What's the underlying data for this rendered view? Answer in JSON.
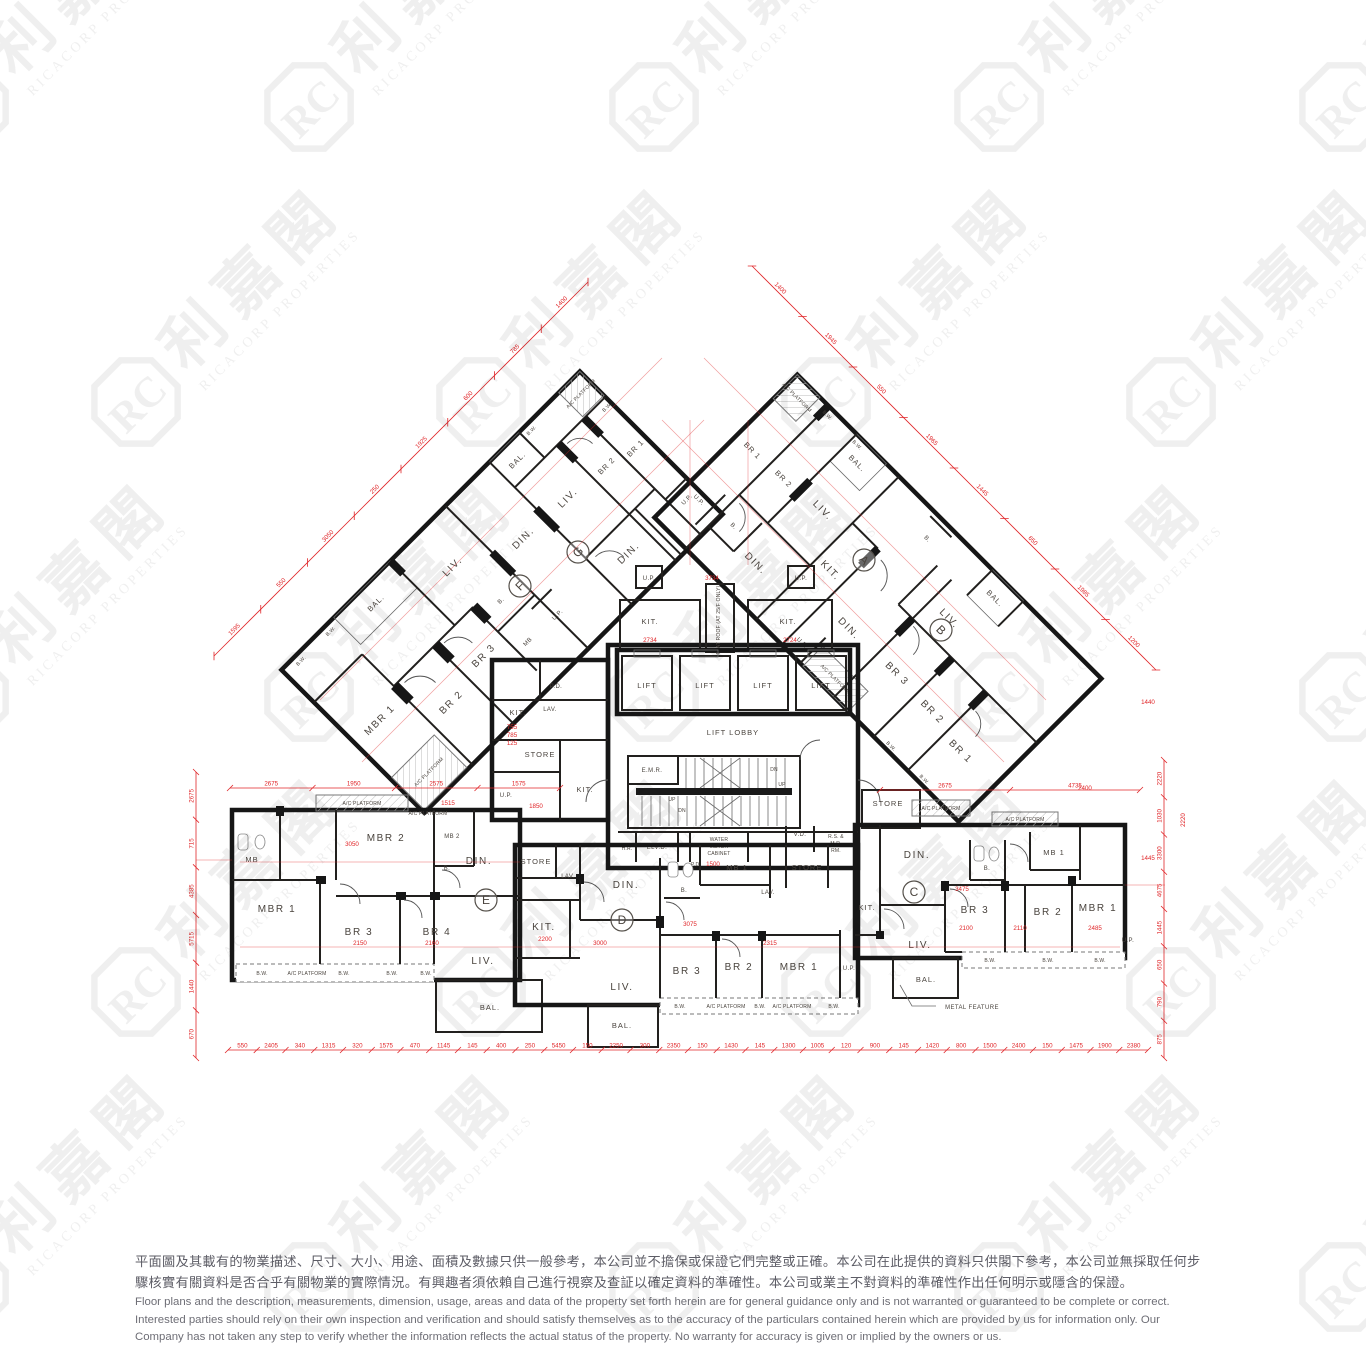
{
  "watermark": {
    "monogram": "RC",
    "cjk": "利嘉閣",
    "latin": "RICACORP PROPERTIES"
  },
  "units": {
    "a": "A",
    "b": "B",
    "c": "C",
    "d": "D",
    "e": "E",
    "f": "F",
    "g": "G"
  },
  "labels": {
    "lift": "LIFT",
    "lift_lobby": "LIFT LOBBY",
    "emr": "E.M.R.",
    "elvd": "ELV.D.",
    "hr": "H.R.",
    "pd": "P.D.",
    "vd": "V.D.",
    "water_meter": [
      "WATER",
      "METER",
      "CABINET"
    ],
    "rs_mr": [
      "R.S. &",
      "M.R.",
      "RM."
    ],
    "up": "UP",
    "dn": "DN",
    "flat_roof": "FLAT ROOF (AT 25/F ONLY)",
    "mbr1": "MBR 1",
    "mbr2": "MBR 2",
    "mb": "MB",
    "mb1": "MB 1",
    "mb2": "MB 2",
    "br1": "BR 1",
    "br2": "BR 2",
    "br3": "BR 3",
    "br4": "BR 4",
    "bath": "B.",
    "liv": "LIV.",
    "din": "DIN.",
    "kit": "KIT.",
    "bal": "BAL.",
    "bw": "B.W.",
    "up_platform": "U.P.",
    "ac_platform": "A/C PLATFORM",
    "store": "STORE",
    "lav": "LAV.",
    "metal_feature": "METAL FEATURE"
  },
  "dims": {
    "bottom": [
      "550",
      "2405",
      "340",
      "1315",
      "320",
      "1575",
      "470",
      "1145",
      "145",
      "400",
      "250",
      "5450",
      "150",
      "2250",
      "300",
      "2350",
      "150",
      "1430",
      "145",
      "1300",
      "1005",
      "120",
      "900",
      "145",
      "1420",
      "800",
      "1500",
      "2400",
      "150",
      "1475",
      "1900",
      "2380"
    ],
    "left": [
      "670",
      "1440",
      "5715",
      "4385",
      "715",
      "2675"
    ],
    "right": [
      "875",
      "790",
      "650",
      "1445",
      "4675",
      "3300",
      "1030",
      "2220"
    ],
    "diag_left": [
      "1595",
      "550",
      "3050",
      "250",
      "1925",
      "600",
      "785",
      "1400"
    ],
    "diag_right": [
      "1400",
      "1945",
      "550",
      "1965",
      "1445",
      "650",
      "1985",
      "1200"
    ],
    "mid_left": [
      "2675",
      "1950",
      "2575",
      "1575"
    ],
    "mid_right": [
      "2675",
      "4735"
    ],
    "inner": [
      "2734",
      "3734",
      "2724",
      "1850",
      "755",
      "785",
      "125",
      "3050",
      "2150",
      "2160",
      "3000",
      "2315",
      "3475",
      "2100",
      "2485",
      "2200",
      "3075",
      "1500",
      "1440",
      "2220",
      "1515",
      "2400",
      "2110",
      "1445"
    ]
  },
  "disclaimer": {
    "zh": [
      "平面圖及其載有的物業描述、尺寸、大小、用途、面積及數據只供一般參考，本公司並不擔保或保證它們完整或正確。本公司在此提供的資料只供閣下參考，本公司並無採取任何步",
      "驟核實有關資料是否合乎有關物業的實際情況。有興趣者須依賴自己進行視察及查証以確定資料的準確性。本公司或業主不對資料的準確性作出任何明示或隱含的保證。"
    ],
    "en": [
      "Floor plans and the description, measurements, dimension, usage, areas and data of the property set forth herein are for general guidance only and is not warranted or guaranteed to be complete or correct.",
      "Interested parties should rely on their own inspection and verification and should satisfy themselves as to the accuracy of the particulars contained herein which are provided by us for information only.  Our",
      "Company has not taken any step to verify whether the information reflects the actual status of the property.  No warranty for accuracy is given or implied by the owners or us."
    ]
  }
}
